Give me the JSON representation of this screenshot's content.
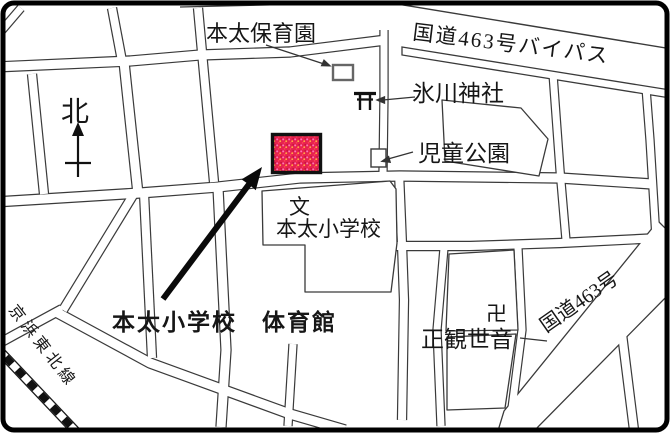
{
  "labels": {
    "nursery": "本太保育園",
    "bypass": "国道463号バイパス",
    "north": "北",
    "shrine": "氷川神社",
    "children_park": "児童公園",
    "school_symbol": "文",
    "elementary_school": "本太小学校",
    "gym": "本太小学校　体育館",
    "manji": "卍",
    "temple": "正観世音",
    "route463": "国道463号",
    "railway_line": "京浜東北線"
  },
  "colors": {
    "highlight": "#e6224e",
    "line": "#3a3a3a",
    "background": "#ffffff",
    "border": "#000000"
  }
}
